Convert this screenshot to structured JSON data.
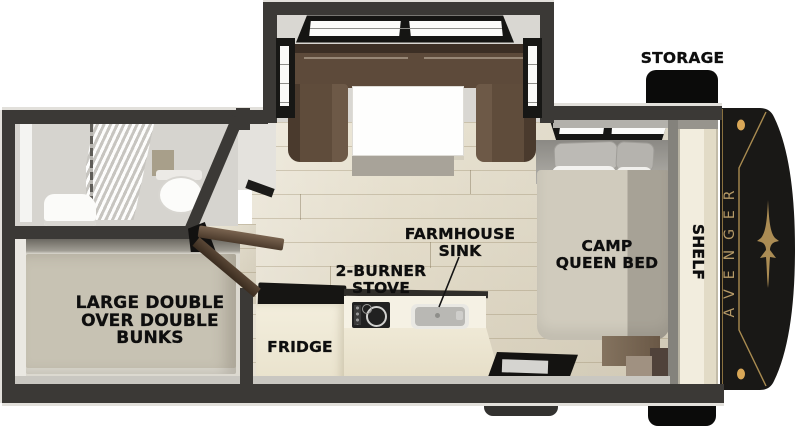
{
  "floorplan": {
    "brand": "AVENGER",
    "labels": {
      "storage": "STORAGE",
      "camp_queen_bed": [
        "CAMP",
        "QUEEN BED"
      ],
      "shelf": "SHELF",
      "farmhouse_sink": [
        "FARMHOUSE",
        "SINK"
      ],
      "two_burner_stove": [
        "2-BURNER",
        "STOVE"
      ],
      "fridge": "FRIDGE",
      "bunks": [
        "LARGE DOUBLE",
        "OVER DOUBLE",
        "BUNKS"
      ]
    },
    "icons": {
      "front_cap_emblem": "eagle-emblem"
    },
    "colors": {
      "wall": "#3b3936",
      "floor_wood": "#e0d9c6",
      "sofa_brown": "#5d4a3a",
      "counter_cream": "#efe9d6",
      "cap_black": "#191816",
      "gold_accent": "#b69a67",
      "label_text": "#0e0e0e"
    }
  }
}
